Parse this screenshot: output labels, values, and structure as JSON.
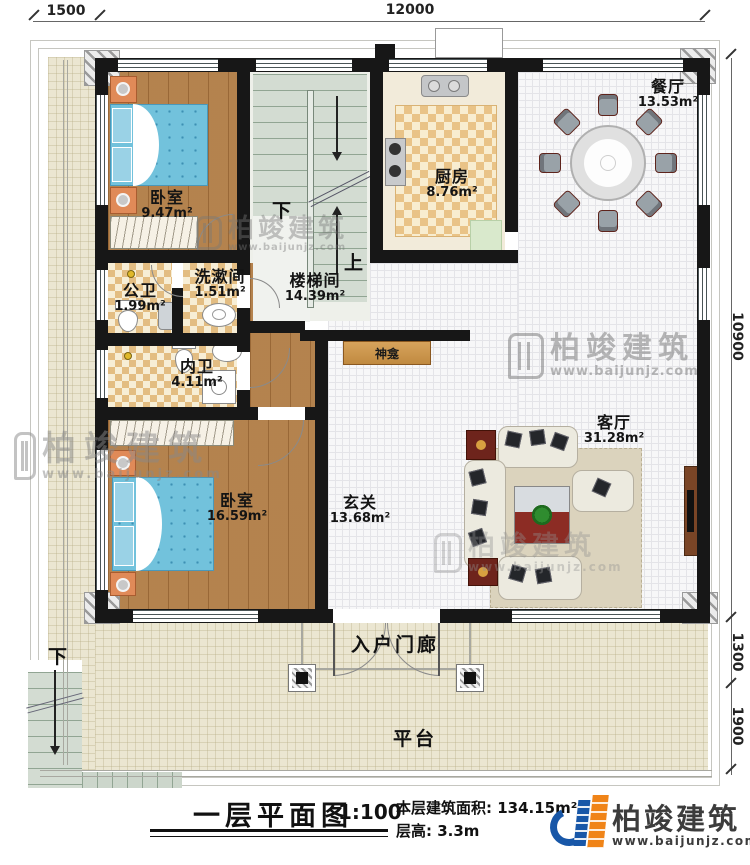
{
  "plan": {
    "dimensions": {
      "top_left": "1500",
      "top_main": "12000",
      "right_height": "10900",
      "right_porch": "1300",
      "right_platform": "1900"
    },
    "rooms": [
      {
        "name": "卧室",
        "area": "9.47m²"
      },
      {
        "name": "楼梯间",
        "area": "14.39m²"
      },
      {
        "name": "厨房",
        "area": "8.76m²"
      },
      {
        "name": "餐厅",
        "area": "13.53m²"
      },
      {
        "name": "公卫",
        "area": "1.99m²"
      },
      {
        "name": "洗漱间",
        "area": "1.51m²"
      },
      {
        "name": "内卫",
        "area": "4.11m²"
      },
      {
        "name": "卧室",
        "area": "16.59m²"
      },
      {
        "name": "玄关",
        "area": "13.68m²"
      },
      {
        "name": "客厅",
        "area": "31.28m²"
      }
    ],
    "annotations": {
      "shrine": "神龛",
      "porch": "入户门廊",
      "platform": "平台",
      "stair_down": "下",
      "stair_up": "上",
      "outdoor_stair_down": "下"
    }
  },
  "titleblock": {
    "title": "一层平面图",
    "scale": "1:100",
    "area_label": "本层建筑面积:",
    "area_value": "134.15m²",
    "height_label": "层高:",
    "height_value": "3.3m"
  },
  "brand": {
    "name": "柏竣建筑",
    "url": "www.baijunjz.com"
  },
  "watermark": {
    "name": "柏竣建筑",
    "url": "www.baijunjz.com"
  }
}
